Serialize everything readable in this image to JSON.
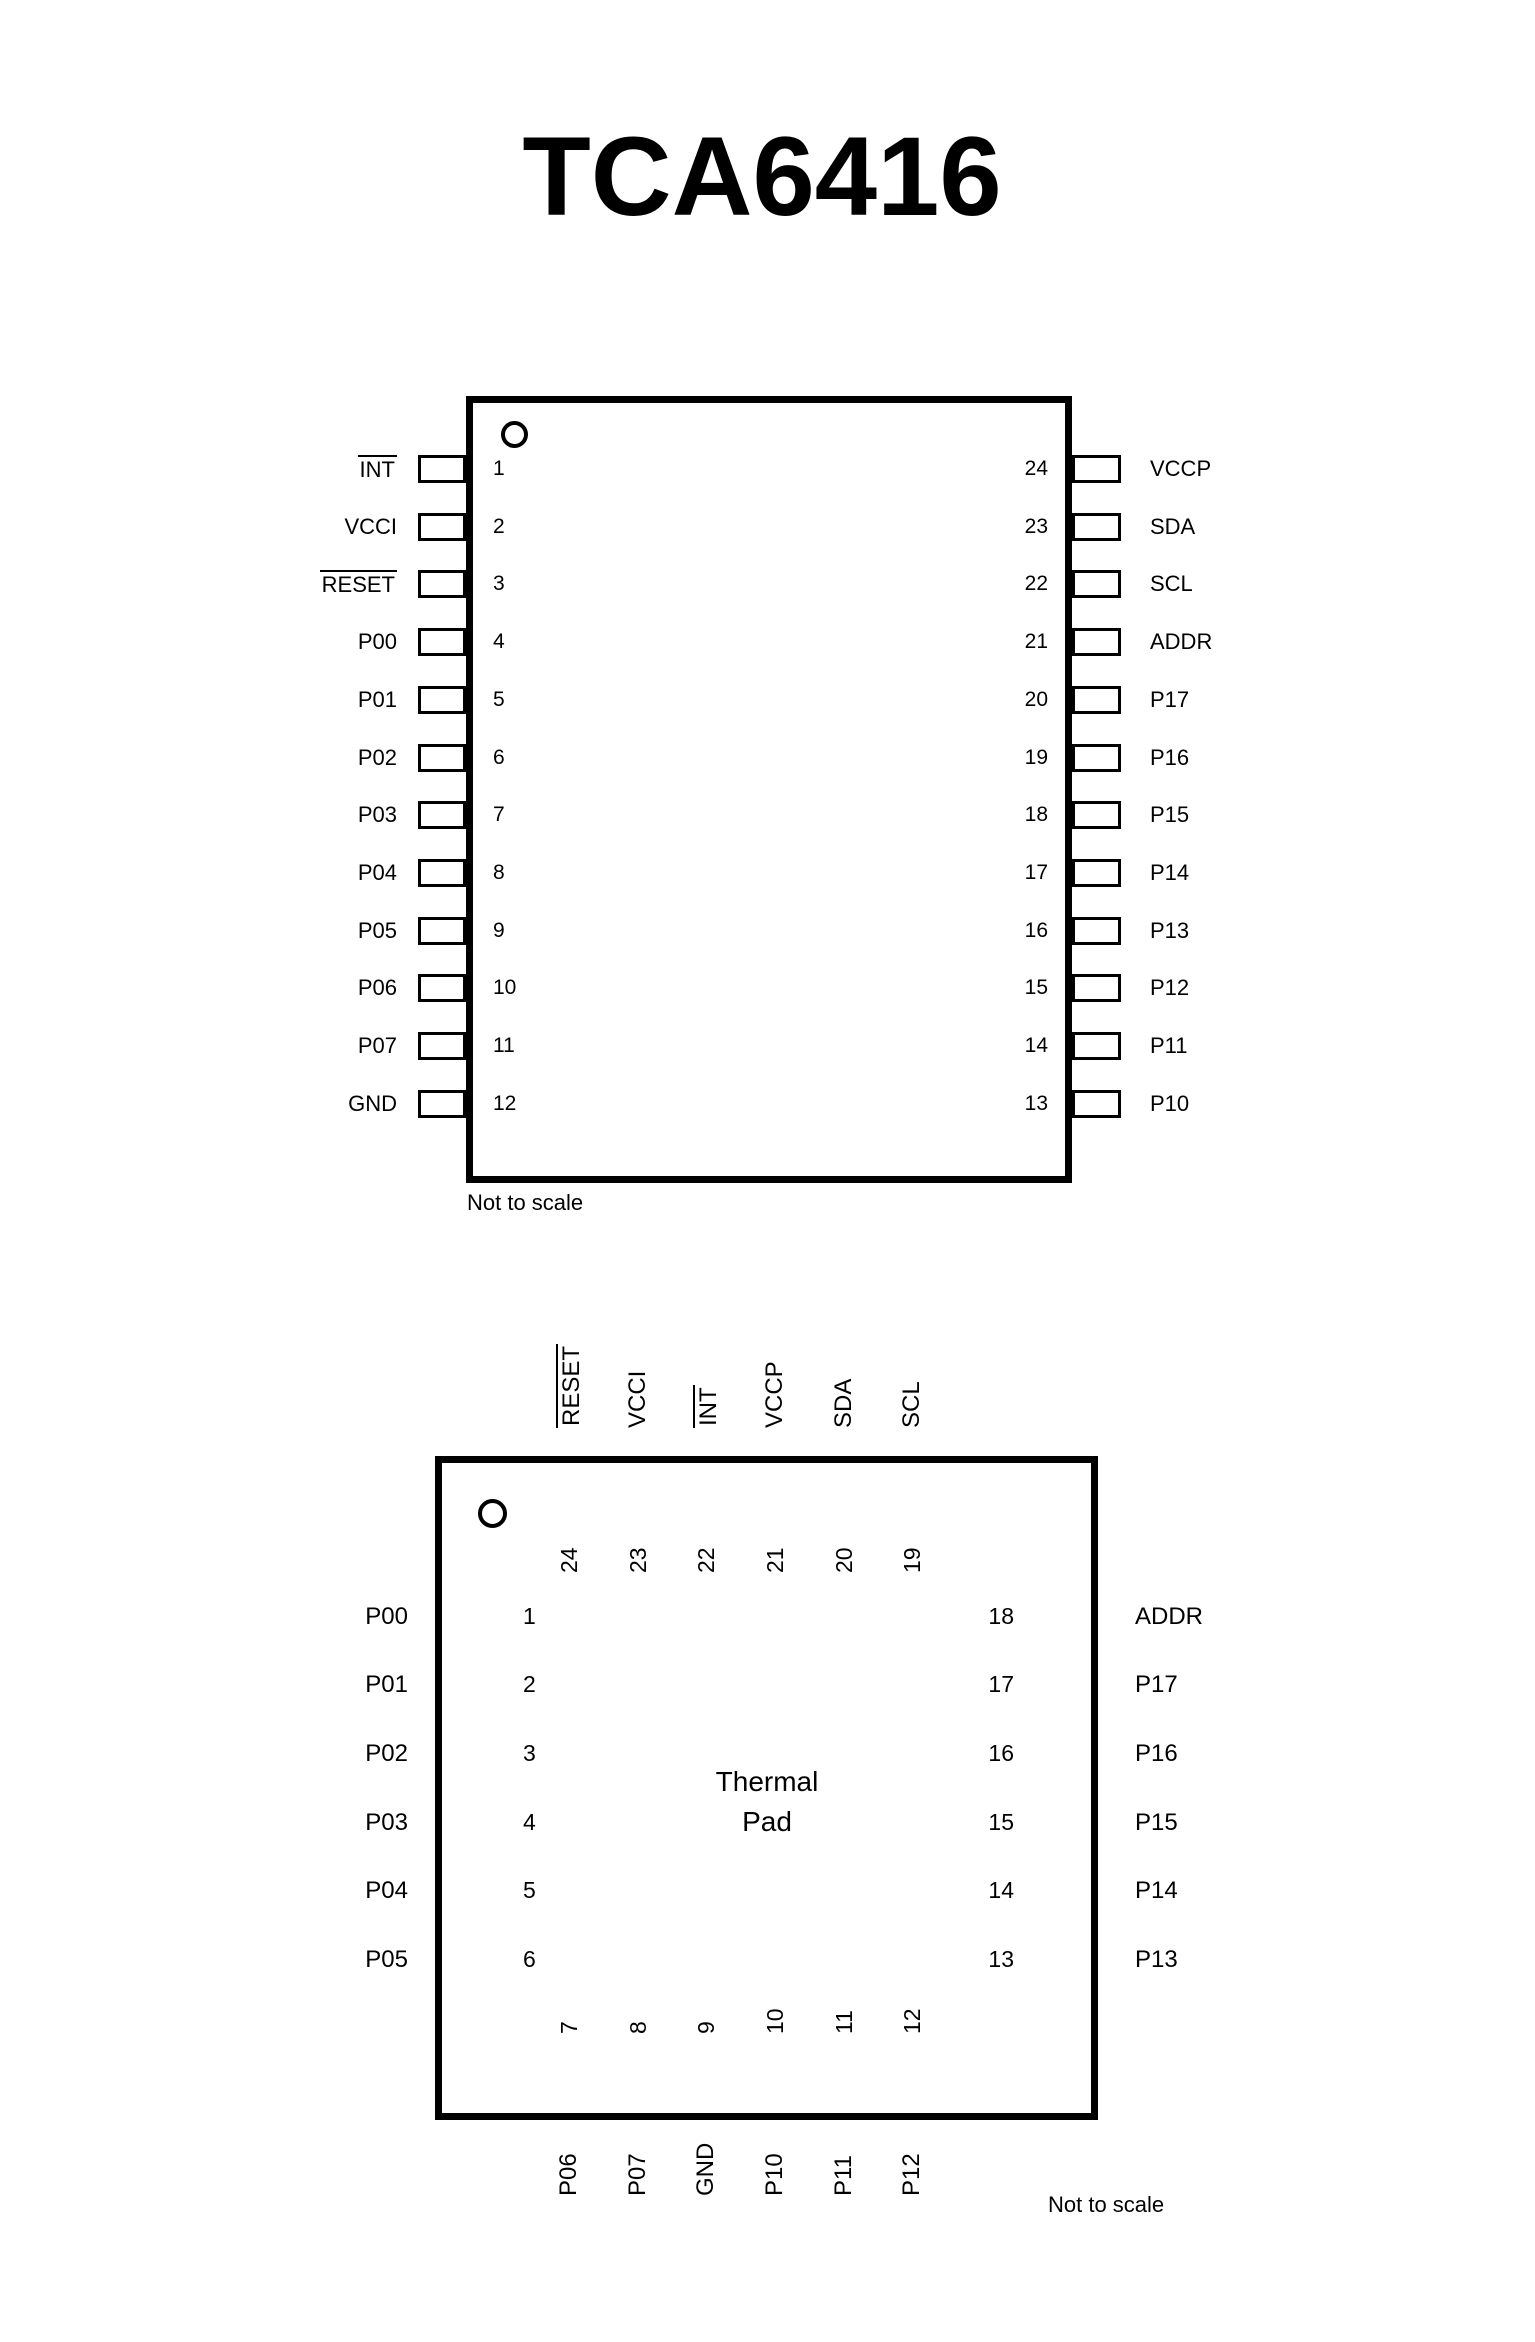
{
  "page": {
    "title": "TCA6416"
  },
  "diagrams": {
    "tssop": {
      "note": "Not to scale",
      "left_pins": [
        {
          "num": "1",
          "label": "INT",
          "overline": true
        },
        {
          "num": "2",
          "label": "VCCI",
          "overline": false
        },
        {
          "num": "3",
          "label": "RESET",
          "overline": true
        },
        {
          "num": "4",
          "label": "P00",
          "overline": false
        },
        {
          "num": "5",
          "label": "P01",
          "overline": false
        },
        {
          "num": "6",
          "label": "P02",
          "overline": false
        },
        {
          "num": "7",
          "label": "P03",
          "overline": false
        },
        {
          "num": "8",
          "label": "P04",
          "overline": false
        },
        {
          "num": "9",
          "label": "P05",
          "overline": false
        },
        {
          "num": "10",
          "label": "P06",
          "overline": false
        },
        {
          "num": "11",
          "label": "P07",
          "overline": false
        },
        {
          "num": "12",
          "label": "GND",
          "overline": false
        }
      ],
      "right_pins": [
        {
          "num": "24",
          "label": "VCCP",
          "overline": false
        },
        {
          "num": "23",
          "label": "SDA",
          "overline": false
        },
        {
          "num": "22",
          "label": "SCL",
          "overline": false
        },
        {
          "num": "21",
          "label": "ADDR",
          "overline": false
        },
        {
          "num": "20",
          "label": "P17",
          "overline": false
        },
        {
          "num": "19",
          "label": "P16",
          "overline": false
        },
        {
          "num": "18",
          "label": "P15",
          "overline": false
        },
        {
          "num": "17",
          "label": "P14",
          "overline": false
        },
        {
          "num": "16",
          "label": "P13",
          "overline": false
        },
        {
          "num": "15",
          "label": "P12",
          "overline": false
        },
        {
          "num": "14",
          "label": "P11",
          "overline": false
        },
        {
          "num": "13",
          "label": "P10",
          "overline": false
        }
      ]
    },
    "qfn": {
      "note": "Not to scale",
      "thermal_pad": {
        "line1": "Thermal",
        "line2": "Pad"
      },
      "top_pins": [
        {
          "num": "24",
          "label": "RESET",
          "overline": true
        },
        {
          "num": "23",
          "label": "VCCI",
          "overline": false
        },
        {
          "num": "22",
          "label": "INT",
          "overline": true
        },
        {
          "num": "21",
          "label": "VCCP",
          "overline": false
        },
        {
          "num": "20",
          "label": "SDA",
          "overline": false
        },
        {
          "num": "19",
          "label": "SCL",
          "overline": false
        }
      ],
      "left_pins": [
        {
          "num": "1",
          "label": "P00",
          "overline": false
        },
        {
          "num": "2",
          "label": "P01",
          "overline": false
        },
        {
          "num": "3",
          "label": "P02",
          "overline": false
        },
        {
          "num": "4",
          "label": "P03",
          "overline": false
        },
        {
          "num": "5",
          "label": "P04",
          "overline": false
        },
        {
          "num": "6",
          "label": "P05",
          "overline": false
        }
      ],
      "right_pins": [
        {
          "num": "18",
          "label": "ADDR",
          "overline": false
        },
        {
          "num": "17",
          "label": "P17",
          "overline": false
        },
        {
          "num": "16",
          "label": "P16",
          "overline": false
        },
        {
          "num": "15",
          "label": "P15",
          "overline": false
        },
        {
          "num": "14",
          "label": "P14",
          "overline": false
        },
        {
          "num": "13",
          "label": "P13",
          "overline": false
        }
      ],
      "bottom_pins": [
        {
          "num": "7",
          "label": "P06",
          "overline": false
        },
        {
          "num": "8",
          "label": "P07",
          "overline": false
        },
        {
          "num": "9",
          "label": "GND",
          "overline": false
        },
        {
          "num": "10",
          "label": "P10",
          "overline": false
        },
        {
          "num": "11",
          "label": "P11",
          "overline": false
        },
        {
          "num": "12",
          "label": "P12",
          "overline": false
        }
      ]
    }
  }
}
